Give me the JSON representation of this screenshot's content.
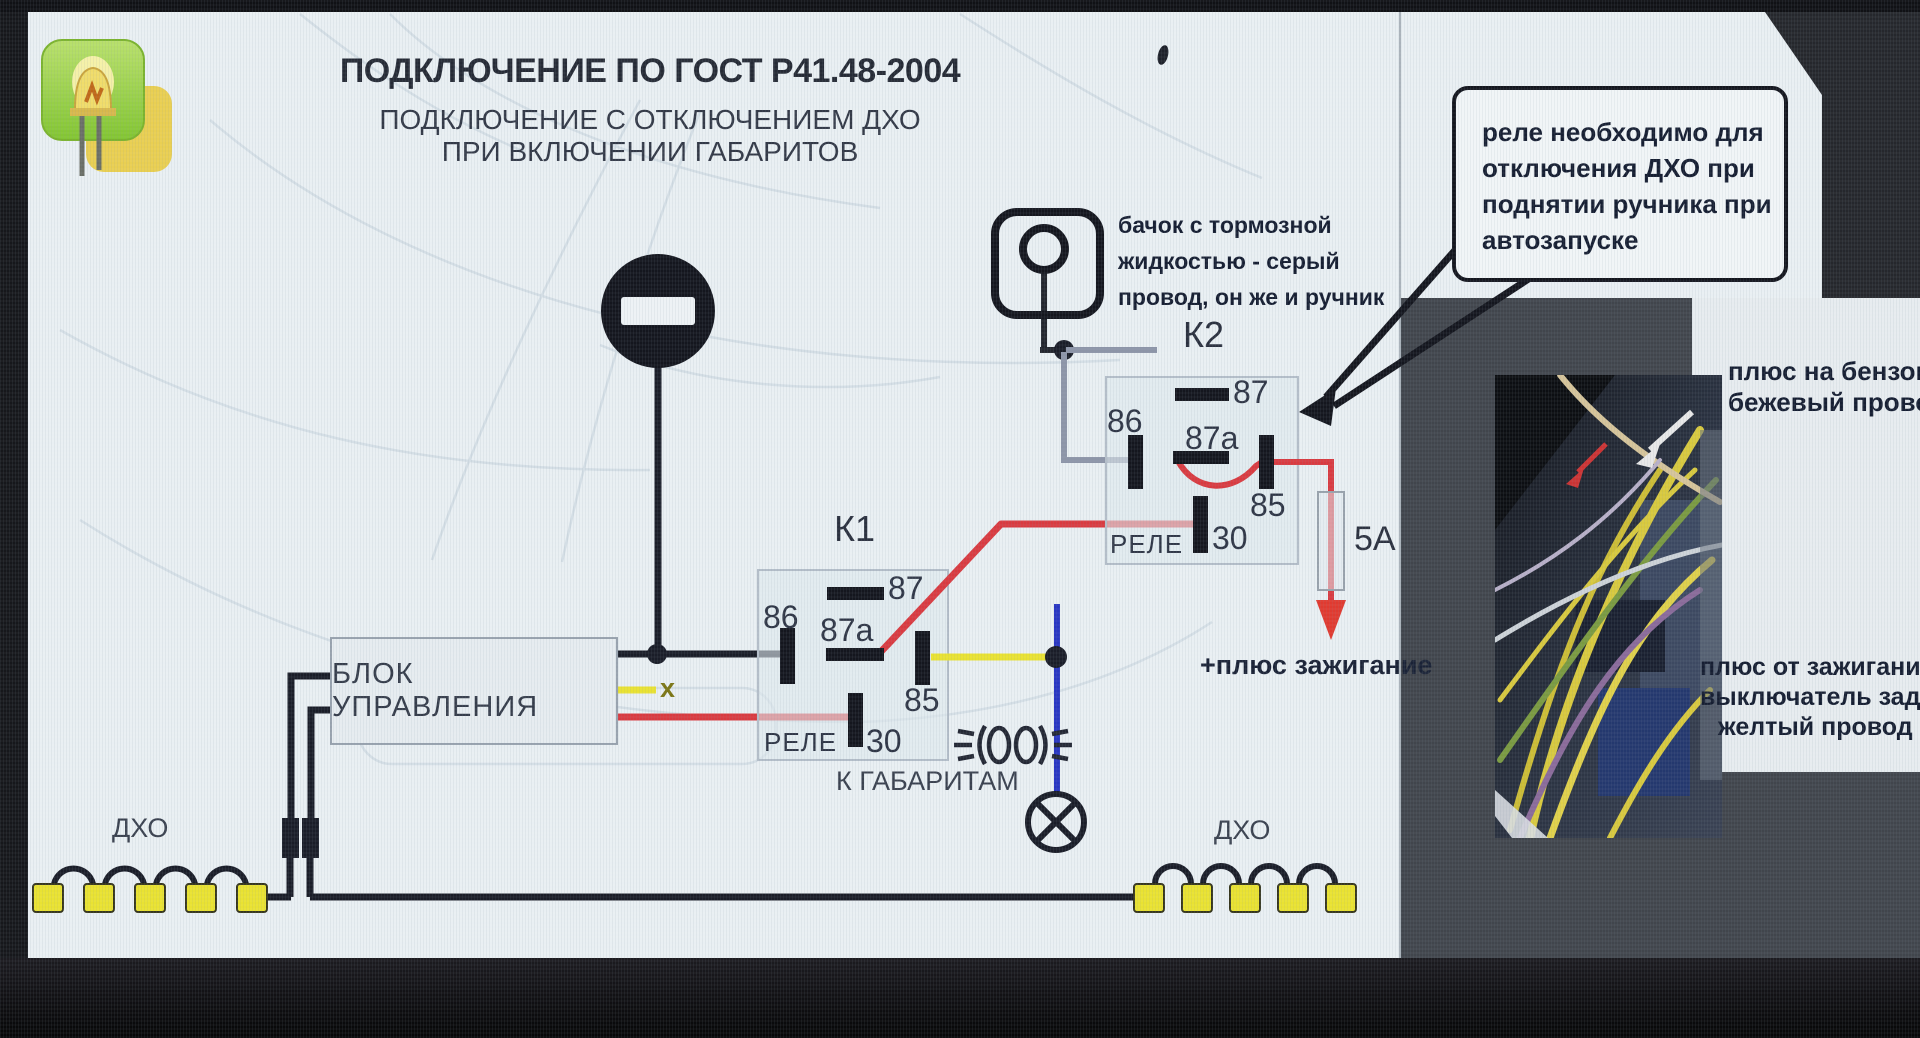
{
  "title": "ПОДКЛЮЧЕНИЕ ПО ГОСТ Р41.48-2004",
  "subtitle_line1": "ПОДКЛЮЧЕНИЕ С ОТКЛЮЧЕНИЕМ ДХО",
  "subtitle_line2": "ПРИ ВКЛЮЧЕНИИ ГАБАРИТОВ",
  "note_box": {
    "lines": [
      "реле необходимо для",
      "отключения ДХО при",
      "поднятии ручника при",
      "автозапуске"
    ]
  },
  "reservoir_caption": {
    "lines": [
      "бачок с тормозной",
      "жидкостью - серый",
      "провод, он же и ручник"
    ]
  },
  "relays": {
    "k1": {
      "name": "К1",
      "rele": "РЕЛЕ",
      "pin87": "87",
      "pin87a": "87a",
      "pin86": "86",
      "pin85": "85",
      "pin30": "30"
    },
    "k2": {
      "name": "К2",
      "rele": "РЕЛЕ",
      "pin87": "87",
      "pin87a": "87a",
      "pin86": "86",
      "pin85": "85",
      "pin30": "30"
    }
  },
  "control_block": {
    "label": "БЛОК УПРАВЛЕНИЯ",
    "x_marker": "х"
  },
  "fuse_label": "5А",
  "ignition_plus": "+плюс зажигание",
  "to_parking_lights": "К ГАБАРИТАМ",
  "drl": {
    "left_label": "ДХО",
    "right_label": "ДХО"
  },
  "photo_caption_top": {
    "lines": [
      "плюс на бензонас",
      "бежевый провод"
    ]
  },
  "photo_caption_bottom": {
    "lines": [
      "плюс от зажигания н",
      "выключатель зад.ход",
      "желтый провод"
    ]
  },
  "colors": {
    "wire_red": "#d93a40",
    "wire_yellow": "#e9e232",
    "wire_blue": "#2836c2",
    "wire_gray": "#8d95a8",
    "wire_black": "#1a1d28",
    "led_square": "#e9e232",
    "slide_bg": "#e9eff3",
    "ink": "#2f3646"
  }
}
